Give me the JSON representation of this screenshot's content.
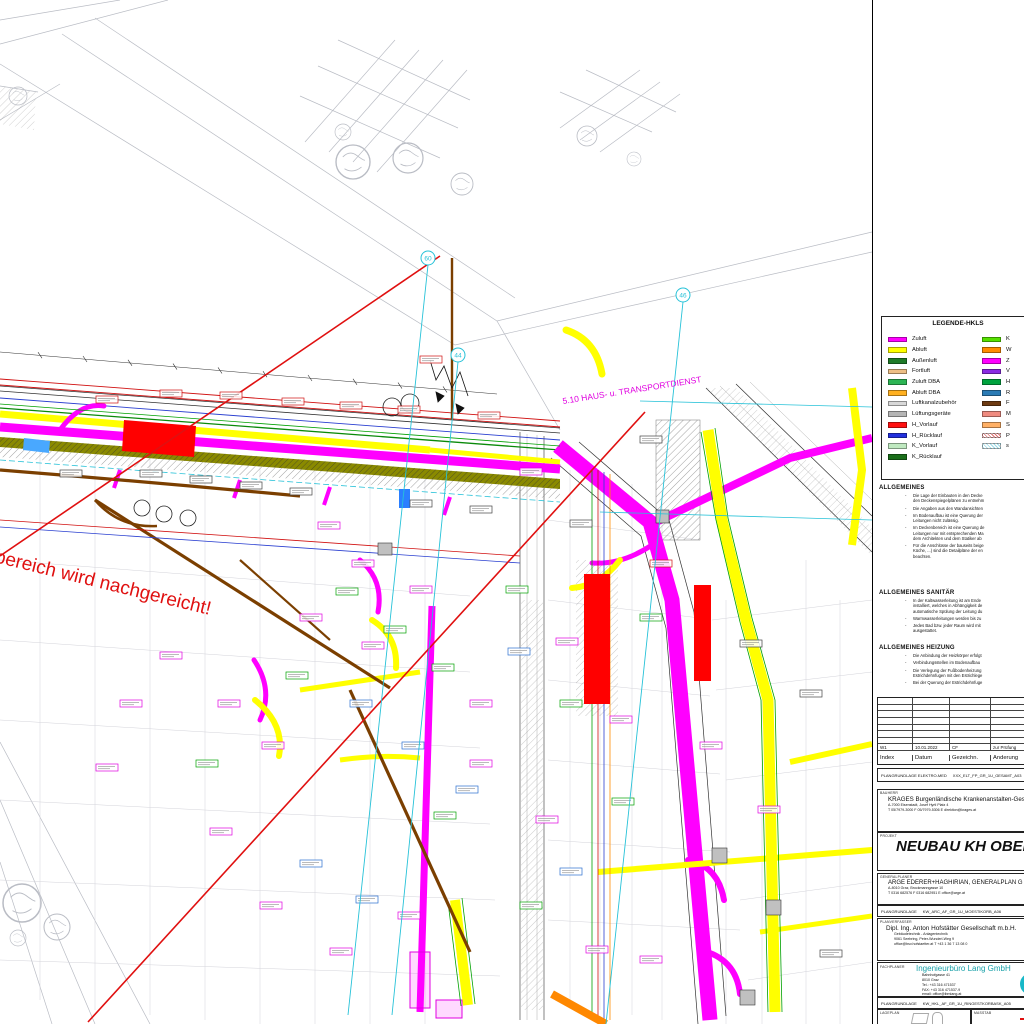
{
  "drawing": {
    "red_note": "bereich wird nachgereicht!",
    "corridor_label": "5.10 HAUS- u. TRANSPORTDIENST",
    "grid_bubbles": [
      "60",
      "46",
      "44"
    ]
  },
  "panel": {
    "legend": {
      "title": "LEGENDE-HKLS",
      "left": [
        {
          "label": "Zuluft",
          "color": "#ff00ff"
        },
        {
          "label": "Abluft",
          "color": "#ffff00"
        },
        {
          "label": "Außenluft",
          "color": "#1f7a28"
        },
        {
          "label": "Fortluft",
          "color": "#edbf86"
        },
        {
          "label": "Zuluft DBA",
          "color": "#2db554"
        },
        {
          "label": "Abluft DBA",
          "color": "#ffb020"
        },
        {
          "label": "Luftkanalzubehör",
          "color": "#d8d8d8"
        },
        {
          "label": "Lüftungsgeräte",
          "color": "#b5b5b5"
        },
        {
          "label": "H_Vorlauf",
          "color": "#ff1111"
        },
        {
          "label": "H_Rücklauf",
          "color": "#2230dd"
        },
        {
          "label": "K_Vorlauf",
          "color": "#bfe9c0"
        },
        {
          "label": "K_Rücklauf",
          "color": "#1a6e1a"
        }
      ],
      "right": [
        {
          "label": "K",
          "color": "#55e000"
        },
        {
          "label": "W",
          "color": "#ff8c00"
        },
        {
          "label": "Z",
          "color": "#ff00ff"
        },
        {
          "label": "V",
          "color": "#8a2be2"
        },
        {
          "label": "H",
          "color": "#00a33e"
        },
        {
          "label": "R",
          "color": "#2b7bb5"
        },
        {
          "label": "F",
          "color": "#6e3b12"
        },
        {
          "label": "M",
          "color": "#ef8b80"
        },
        {
          "label": "S",
          "color": "#ffb066"
        },
        {
          "label": "P",
          "color": "#e06a6a"
        },
        {
          "label": "s",
          "color": "#9adbe8"
        }
      ]
    },
    "allgemeines": {
      "title": "ALLGEMEINES",
      "items": [
        "Die Lage der Einbauten in den Decke\nden Deckenspiegelplänen zu entnehm",
        "Die Angaben aus den Wandansichten",
        "Im Bodenaufbau ist eine Querung der\nLeitungen nicht zulässig.",
        "Im Deckenbereich ist eine Querung de\nLeitungen nur mit entsprechenden Ma\ndem Architekten und dem Statiker ab",
        "Für die Anschlüsse der bauseits beige\nKüche, ...) sind die Detailpläne der en\nbeachten."
      ]
    },
    "sanitaer": {
      "title": "ALLGEMEINES SANITÄR",
      "items": [
        "In der Kaltwasserleitung ist am Ende\ninstalliert, welches in Abhängigkeit de\nautomatische Spülung der Leitung du",
        "Warmwasserleitungen werden bis zu",
        "Jedes Bad bzw. jeder Raum wird mit\nausgestattet."
      ]
    },
    "heizung": {
      "title": "ALLGEMEINES HEIZUNG",
      "items": [
        "Die Anbindung der Heizkörper erfolgt",
        "Verbindungsstellen im Bodenaufbau",
        "Die Verlegung der Fußbodenheizung\nEstrichdehnfugen mit den Estrichlege",
        "Bei der Querung der Estrichdehnfuge"
      ]
    },
    "revision": {
      "headers": [
        "Index",
        "Datum",
        "Gezeichn.",
        "Änderung"
      ],
      "row": {
        "index": "W1",
        "datum": "10.01.2022",
        "gezeichn": "CF",
        "aenderung": "zur Prüfung"
      }
    },
    "plangrundlage_elektro": {
      "label": "PLANGRUNDLAGE ELEKTRO-MED",
      "value": "XXX_ELT_FP_GR_1U_GESAMT_A03"
    },
    "bauherr": {
      "label": "BAUHERR",
      "name": "KRAGES Burgenländische Krankenanstalten-Ges",
      "address": "A-7000 Eisenstadt, Josef Hyrtl Platz 4",
      "contact": "T 05/7979-3000      F 05/7979-5306      E direktion@krages.at"
    },
    "projekt": {
      "label": "PROJEKT",
      "title": "NEUBAU KH OBERW"
    },
    "generalplaner": {
      "label": "GENERALPLANER",
      "name": "ARGE EDERER+HAGHIRIAN, GENERALPLAN G",
      "address": "A-8010 Graz, Brockmanngasse 10",
      "contact": "T 0316 682576      F 0316 682951      E office@arge.at"
    },
    "plangrundlage_arc": {
      "label": "PLANGRUNDLAGE",
      "value": "KW_ARC_AF_GR_1U_MOESTIKORB_A06"
    },
    "planverfasser": {
      "label": "PLANVERFASSER",
      "name": "Dipl. Ing. Anton Hofstätter Gesellschaft m.b.H.",
      "line2": "Gebäudetechnik - Anlagentechnik",
      "line3": "9061 Seebring, Peter-Wunderl-Weg 9",
      "line4": "office@bsv.hofstaetter.at        T +43 1 36 7 13 08 0"
    },
    "fachplaner": {
      "label": "FACHPLANER",
      "name": "Ingenieurbüro Lang GmbH",
      "name_color": "#18a0a8",
      "lines": [
        "Bahnhofgasse          41",
        "8010              Graz",
        "Tel.:    +43 316 471537",
        "FAX: +43 316 471537-9",
        "email:  office@ibmlang.at"
      ]
    },
    "plangrundlage_hkl": {
      "label": "PLANGRUNDLAGE",
      "value": "KW_HKL_AF_GR_1U_RINGESTKORBASK_A05"
    },
    "lageplan_label": "LAGEPLAN",
    "massstab_label": "MASSTAB"
  }
}
